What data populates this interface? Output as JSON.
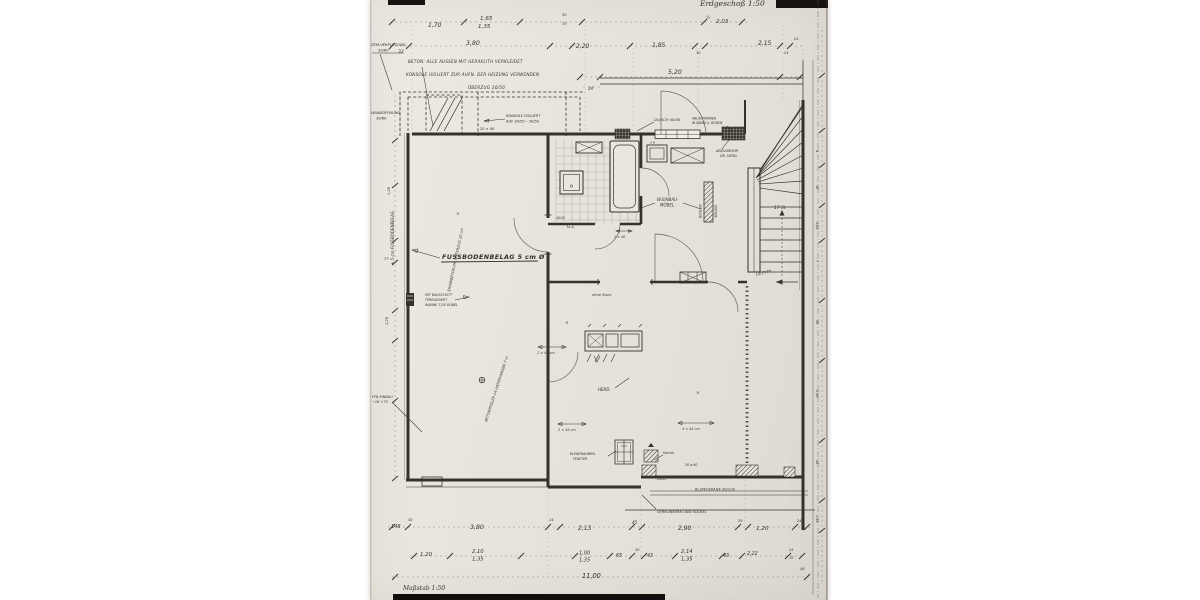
{
  "colors": {
    "paper": "#e7e3dc",
    "ink": "#36322b",
    "ink_light": "#6b665c",
    "scan_bar": "#161310"
  },
  "header": {
    "cut_note": "Erdgeschoß 1:50",
    "half_mark": "½"
  },
  "notes": {
    "beton": "BETON: ALLE AUSSEN MIT HERAKLITH VERKLEIDET",
    "konsole": "KONSOLE ISOLIERT ZUR AUFN. DER HEIZUNG VERWENDEN",
    "ueberzug": "ÜBERZUG 30/50",
    "konsole2a": "KONSOLE ISOLIERT",
    "konsole2b": "AUF 30/50 – 30/50",
    "zem1": "ZEM.VERPUTZUNG",
    "zem2": "30/60",
    "wand1": "WANDÖFFNUNG",
    "wand2": "30/60",
    "left_wall_vert": "± 5 cm FUSSBODENBELAG",
    "wall_dim": "20 × 86",
    "fussboden": "FUSSBODENBELAG 5 cm Ø",
    "bauschutt1": "MIT BAUSCHUTT",
    "bauschutt2": "TERRASSIERT",
    "bauschutt3": "WANNE 7/30 DÜBEL",
    "ffb1": "FFB EINBAU",
    "ffb2": "−18 +75",
    "diag1": "SPANNBETON-Pfl. UNTERZUG 32 cm",
    "diag2": "BETONPFEILER 14 UNTERFANGEN 7 m",
    "dusch": "DU/SCH 40/40",
    "ablauf1": "ABLAUFRINNEN",
    "ablauf2": "IN WAND U. BODEN",
    "abzug1": "ABZUGROHR",
    "abzug2": "ÜB. HERD",
    "einbau1": "W.EINBAU-",
    "einbau2": "MÖBEL",
    "ab_box": "A B",
    "boiler": "BOILER",
    "boiler2": "400/400",
    "stair_count": "17 St",
    "stair_step": "14/17/26",
    "gl": "G.L.",
    "d4045": "40/45",
    "ohne_sturz": "ohne Sturz",
    "herd": "HERD.",
    "blend1": "BLENDRAHMEN-",
    "blend2": "FENSTER",
    "d3080": "30 a 80",
    "kamin": "Kamin",
    "d2025": "20/25",
    "d2048": "20 a 80",
    "blumenbank": "BLUMENBANK BUCHE",
    "verklinker": "VERKLINKERN UND SOCKEL",
    "arr245": "2 × 45 cm",
    "arr445": "4 × 45 cm",
    "arr140": "1 × 40",
    "xmark": "×"
  },
  "dims_top": {
    "d170": "1,70",
    "d165": "1,65",
    "d135": "1,35",
    "s30": "30",
    "s70": "70",
    "d203": "2,03",
    "d32": "32",
    "d380": "3,80",
    "d220": "2,20",
    "d185": "1,85",
    "s30b": "30",
    "d215": "2,15",
    "s24": "24",
    "d520": "5,20",
    "s24b": "24",
    "s24c": "24"
  },
  "dims_bottom": {
    "d148": "148",
    "s30": "30",
    "d380": "3,80",
    "s14": "14",
    "d213": "2,13",
    "s45": "45",
    "d290": "2,90",
    "s29": "29",
    "d120": "1,20",
    "s24": "24",
    "e120": "1,20",
    "e210": "2,10",
    "e135a": "1,35",
    "e100": "1,00",
    "e135b": "1,35",
    "e65": "65",
    "e30": "30",
    "e43a": "43",
    "e214": "2,14",
    "e135c": "1,35",
    "e43b": "43",
    "e222": "2,22",
    "e14": "14",
    "e12": "12",
    "total": "11,00",
    "s48": "48",
    "masstab": "Maßstab 1:50"
  },
  "dims_right": {
    "r1": "8",
    "r2": "30",
    "r3": "1,85",
    "r4": "7",
    "r5": "30",
    "r6": "2,90",
    "r7": "45",
    "r8": "1,35"
  },
  "dims_left": {
    "l1": "1,28",
    "l2": "77",
    "l3": "1,20"
  }
}
